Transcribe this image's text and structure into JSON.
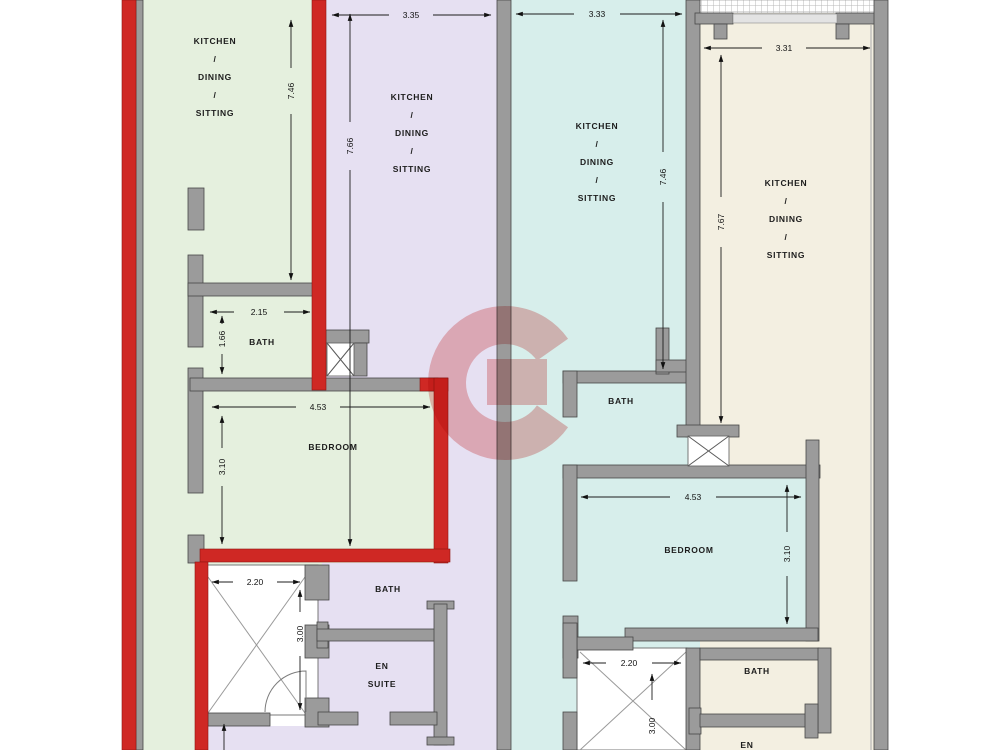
{
  "labels": {
    "kitchen": "KITCHEN",
    "slash": "/",
    "dining": "DINING",
    "sitting": "SITTING",
    "bath": "BATH",
    "bedroom": "BEDROOM",
    "en": "EN",
    "suite": "SUITE"
  },
  "dimensions": {
    "unit1": {
      "height": "7.46",
      "bath_width": "2.15",
      "bath_height": "1.66",
      "bedroom_width": "4.53",
      "bedroom_height": "3.10",
      "void_width": "2.20",
      "void_height": "3.00"
    },
    "unit2": {
      "width": "3.35",
      "height": "7.66"
    },
    "unit3": {
      "width": "3.33",
      "height": "7.46",
      "bedroom_width": "4.53",
      "bedroom_height": "3.10",
      "void_width": "2.20",
      "void_height": "3.00"
    },
    "unit4": {
      "width": "3.31",
      "height": "7.67"
    }
  },
  "colors": {
    "unit1_floor": "#e5f0de",
    "unit2_floor": "#e6e0f2",
    "unit3_floor": "#d7eeeb",
    "unit4_floor": "#f3efe1",
    "highlight_outline": "#cf2824",
    "wall_gray": "#9b9b9b",
    "watermark_red": "#e06464"
  }
}
